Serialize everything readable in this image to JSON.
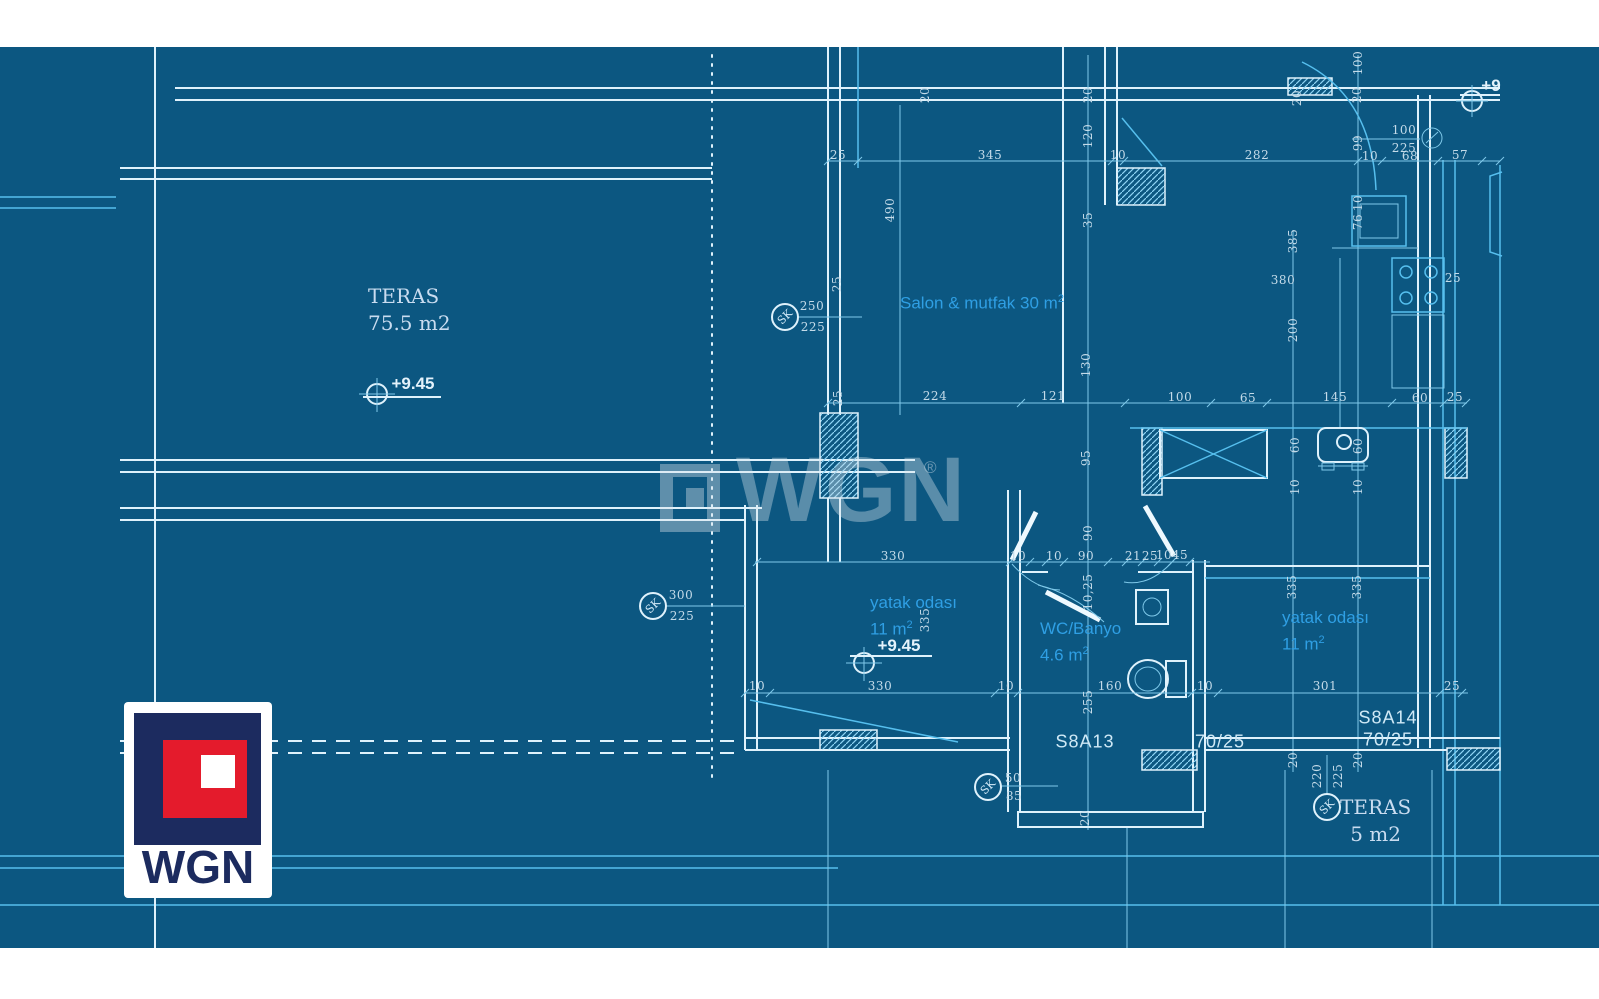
{
  "colors": {
    "blueprint_bg": "#0c5781",
    "line_bright": "#dff2fc",
    "line_cyan": "#56bfee",
    "room_label_blue": "#2f9fe4",
    "dim_text": "#c4dbe9",
    "logo_navy": "#1c2b5f",
    "logo_red": "#e41b2c"
  },
  "watermark": {
    "brand": "WGN",
    "registered": "®"
  },
  "logo": {
    "brand": "WGN"
  },
  "room_labels": [
    {
      "id": "teras-main",
      "cls": "serif",
      "x": 368,
      "y": 283,
      "lines": [
        {
          "t": "TERAS"
        },
        {
          "t": "75.5 m2"
        }
      ]
    },
    {
      "id": "salon",
      "cls": "blue",
      "x": 900,
      "y": 288,
      "lines": [
        {
          "t": "Salon & mutfak 30 m",
          "sup": "2"
        }
      ]
    },
    {
      "id": "bedroom-left",
      "cls": "blue",
      "x": 870,
      "y": 592,
      "lines": [
        {
          "t": "yatak odası"
        },
        {
          "t": "11 m",
          "sup": "2"
        }
      ]
    },
    {
      "id": "wc-banyo",
      "cls": "blue",
      "x": 1040,
      "y": 618,
      "lines": [
        {
          "t": "WC/Banyo"
        },
        {
          "t": "4.6 m",
          "sup": "2"
        }
      ]
    },
    {
      "id": "bedroom-right",
      "cls": "blue",
      "x": 1282,
      "y": 607,
      "lines": [
        {
          "t": "yatak odası"
        },
        {
          "t": "11 m",
          "sup": "2"
        }
      ]
    },
    {
      "id": "teras-small",
      "cls": "serif center",
      "x": 1340,
      "y": 794,
      "lines": [
        {
          "t": "TERAS"
        },
        {
          "t": "5 m2"
        }
      ]
    }
  ],
  "plan_labels": [
    {
      "t": "S8A13",
      "x": 1085,
      "y": 742
    },
    {
      "t": "70/25",
      "x": 1220,
      "y": 742
    },
    {
      "t": "S8A14",
      "x": 1388,
      "y": 718
    },
    {
      "t": "70/25",
      "x": 1388,
      "y": 740
    }
  ],
  "dims": [
    {
      "t": "25",
      "x": 838,
      "y": 155
    },
    {
      "t": "345",
      "x": 990,
      "y": 155
    },
    {
      "t": "10",
      "x": 1118,
      "y": 155
    },
    {
      "t": "282",
      "x": 1257,
      "y": 155
    },
    {
      "t": "10",
      "x": 1370,
      "y": 156
    },
    {
      "t": "68",
      "x": 1410,
      "y": 156
    },
    {
      "t": "57",
      "x": 1460,
      "y": 155
    },
    {
      "t": "100",
      "x": 1358,
      "y": 63,
      "r": -90
    },
    {
      "t": "20",
      "x": 925,
      "y": 95,
      "r": -90
    },
    {
      "t": "20",
      "x": 1088,
      "y": 95,
      "r": -90
    },
    {
      "t": "20",
      "x": 1297,
      "y": 98,
      "r": -90
    },
    {
      "t": "20",
      "x": 1357,
      "y": 95,
      "r": -90
    },
    {
      "t": "120",
      "x": 1088,
      "y": 136,
      "r": -90
    },
    {
      "t": "99",
      "x": 1358,
      "y": 143,
      "r": -90
    },
    {
      "t": "490",
      "x": 890,
      "y": 210,
      "r": -90
    },
    {
      "t": "35",
      "x": 1088,
      "y": 220,
      "r": -90
    },
    {
      "t": "10",
      "x": 1358,
      "y": 203,
      "r": -90
    },
    {
      "t": "76",
      "x": 1358,
      "y": 222,
      "r": -90
    },
    {
      "t": "385",
      "x": 1293,
      "y": 241,
      "r": -90
    },
    {
      "t": "380",
      "x": 1283,
      "y": 280
    },
    {
      "t": "25",
      "x": 1453,
      "y": 278
    },
    {
      "t": "200",
      "x": 1293,
      "y": 330,
      "r": -90
    },
    {
      "t": "130",
      "x": 1086,
      "y": 365,
      "r": -90
    },
    {
      "t": "25",
      "x": 837,
      "y": 284,
      "r": -90
    },
    {
      "t": "25",
      "x": 838,
      "y": 398,
      "r": -90
    },
    {
      "t": "224",
      "x": 935,
      "y": 396
    },
    {
      "t": "121",
      "x": 1053,
      "y": 396
    },
    {
      "t": "100",
      "x": 1180,
      "y": 397
    },
    {
      "t": "65",
      "x": 1248,
      "y": 398
    },
    {
      "t": "145",
      "x": 1335,
      "y": 397
    },
    {
      "t": "60",
      "x": 1420,
      "y": 398
    },
    {
      "t": "25",
      "x": 1455,
      "y": 397
    },
    {
      "t": "60",
      "x": 1295,
      "y": 445,
      "r": -90
    },
    {
      "t": "60",
      "x": 1358,
      "y": 446,
      "r": -90
    },
    {
      "t": "95",
      "x": 1086,
      "y": 458,
      "r": -90
    },
    {
      "t": "10",
      "x": 1295,
      "y": 487,
      "r": -90
    },
    {
      "t": "10",
      "x": 1358,
      "y": 487,
      "r": -90
    },
    {
      "t": "90",
      "x": 1088,
      "y": 533,
      "r": -90
    },
    {
      "t": "330",
      "x": 893,
      "y": 556
    },
    {
      "t": "10",
      "x": 1018,
      "y": 556
    },
    {
      "t": "10",
      "x": 1054,
      "y": 556
    },
    {
      "t": "90",
      "x": 1086,
      "y": 556
    },
    {
      "t": "21",
      "x": 1133,
      "y": 556
    },
    {
      "t": "25",
      "x": 1150,
      "y": 556
    },
    {
      "t": "10",
      "x": 1164,
      "y": 555
    },
    {
      "t": "45",
      "x": 1180,
      "y": 555
    },
    {
      "t": "10,25",
      "x": 1088,
      "y": 592,
      "r": -90
    },
    {
      "t": "335",
      "x": 925,
      "y": 620,
      "r": -90
    },
    {
      "t": "335",
      "x": 1292,
      "y": 587,
      "r": -90
    },
    {
      "t": "335",
      "x": 1357,
      "y": 587,
      "r": -90
    },
    {
      "t": "255",
      "x": 1088,
      "y": 702,
      "r": -90
    },
    {
      "t": "10",
      "x": 757,
      "y": 686
    },
    {
      "t": "330",
      "x": 880,
      "y": 686
    },
    {
      "t": "10",
      "x": 1006,
      "y": 686
    },
    {
      "t": "160",
      "x": 1110,
      "y": 686
    },
    {
      "t": "10",
      "x": 1205,
      "y": 686
    },
    {
      "t": "301",
      "x": 1325,
      "y": 686
    },
    {
      "t": "25",
      "x": 1452,
      "y": 686
    },
    {
      "t": "20",
      "x": 1293,
      "y": 760,
      "r": -90
    },
    {
      "t": "20",
      "x": 1358,
      "y": 760,
      "r": -90
    },
    {
      "t": "20",
      "x": 1085,
      "y": 818,
      "r": -90
    }
  ],
  "markers": [
    {
      "label": "SK",
      "cx": 785,
      "cy": 317,
      "num_top": "250",
      "tx": 812,
      "ty": 306,
      "num_bot": "225",
      "bx": 813,
      "by": 327
    },
    {
      "label": "SK",
      "cx": 653,
      "cy": 606,
      "num_top": "300",
      "tx": 681,
      "ty": 595,
      "num_bot": "225",
      "bx": 682,
      "by": 616
    },
    {
      "label": "SK",
      "cx": 988,
      "cy": 787,
      "num_top": "50",
      "tx": 1013,
      "ty": 778,
      "num_bot": "85",
      "bx": 1014,
      "by": 796
    },
    {
      "label": "SK",
      "cx": 1327,
      "cy": 807,
      "num_top": "220",
      "tx": 1317,
      "ty": 776,
      "num_bot": "225",
      "bx": 1338,
      "by": 776,
      "rot": true
    },
    {
      "label": "",
      "cx": 1432,
      "cy": 138,
      "num_top": "100",
      "tx": 1404,
      "ty": 130,
      "num_bot": "225",
      "bx": 1404,
      "by": 148
    }
  ],
  "elevations": [
    {
      "t": "+9.45",
      "tx": 413,
      "ty": 384
    },
    {
      "t": "+9.45",
      "tx": 899,
      "ty": 646
    },
    {
      "t": "+9",
      "tx": 1491,
      "ty": 86
    }
  ]
}
